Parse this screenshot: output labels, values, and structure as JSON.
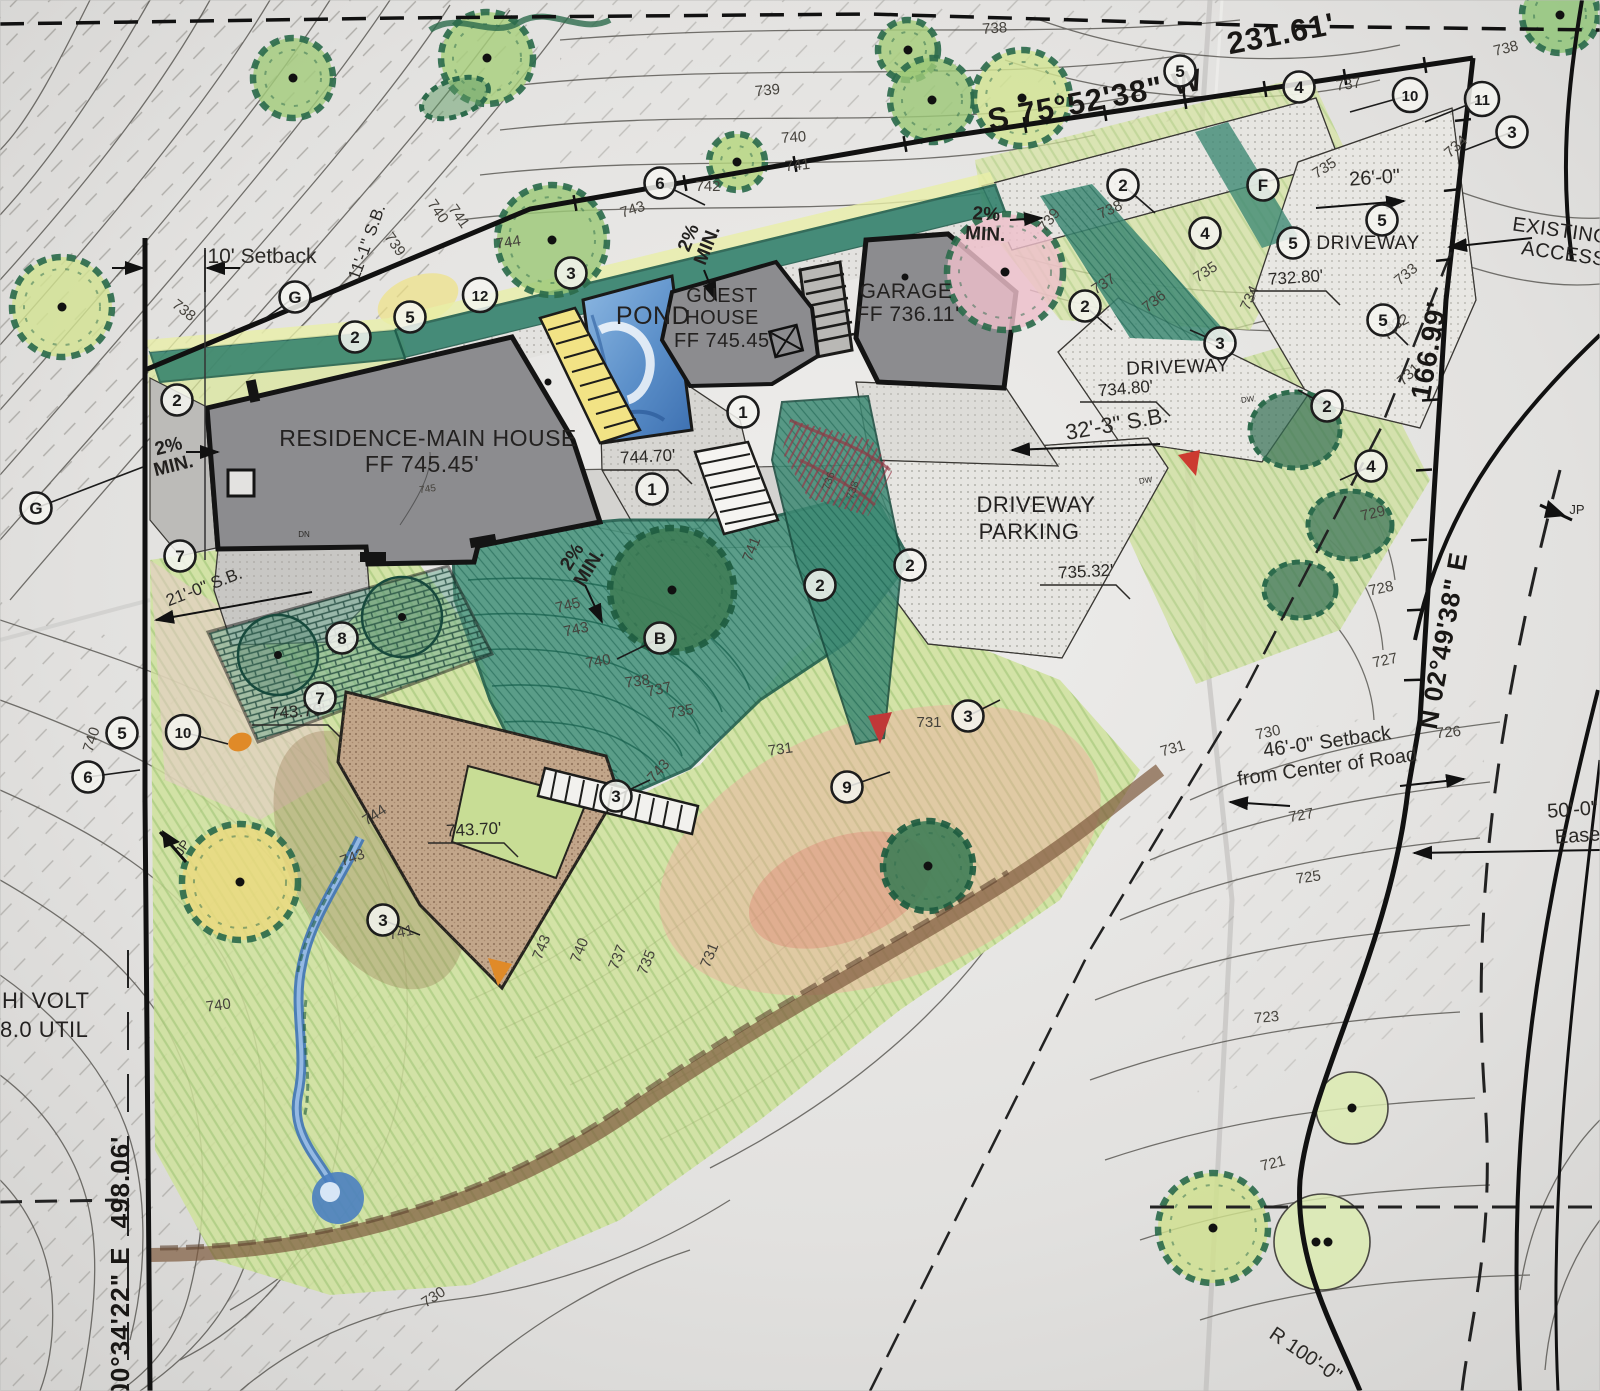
{
  "meta": {
    "description": "Hand-colored architectural site plan with residence, guest house, garage, pond and driveways over topographic contours"
  },
  "colors": {
    "paper": "#e3e2e0",
    "ink": "#2b2926",
    "building_gray": "#8c8c8f",
    "teal_planting": "#47937c",
    "lawn_green": "#cfe29b",
    "light_green": "#d6e4a0",
    "pink": "#eec0cb",
    "red_blush": "#f0a8a0",
    "pond_blue": "#5b8fc9",
    "patio_tan": "#c2a68a",
    "tree_yellow": "#ecd97e",
    "orange": "#e08a28"
  },
  "text_layers": {
    "bearings": [
      {
        "t": "231.61'",
        "x": 1283,
        "y": 44,
        "s": 31,
        "r": -11
      },
      {
        "t": "S 75°52'38\" W",
        "x": 1097,
        "y": 110,
        "s": 31,
        "r": -11
      },
      {
        "t": "166.99'",
        "x": 1438,
        "y": 352,
        "s": 28,
        "r": -80
      },
      {
        "t": "N 02°49'38\" E",
        "x": 1452,
        "y": 642,
        "s": 26,
        "r": -80
      },
      {
        "t": "498.06'",
        "x": 129,
        "y": 1182,
        "s": 26,
        "r": -90
      },
      {
        "t": "00°34'22\" E",
        "x": 129,
        "y": 1322,
        "s": 26,
        "r": -90
      }
    ],
    "buildings": [
      {
        "t": "RESIDENCE-MAIN HOUSE",
        "x": 428,
        "y": 446,
        "s": 23
      },
      {
        "t": "FF 745.45'",
        "x": 422,
        "y": 472,
        "s": 23
      },
      {
        "t": "GUEST",
        "x": 722,
        "y": 302,
        "s": 20
      },
      {
        "t": "HOUSE",
        "x": 722,
        "y": 324,
        "s": 20
      },
      {
        "t": "FF 745.45'",
        "x": 724,
        "y": 347,
        "s": 20
      },
      {
        "t": "GARAGE",
        "x": 906,
        "y": 298,
        "s": 21
      },
      {
        "t": "FF 736.11'",
        "x": 908,
        "y": 321,
        "s": 21
      }
    ],
    "site": [
      {
        "t": "POND",
        "x": 653,
        "y": 324,
        "s": 25
      },
      {
        "t": "DRIVEWAY",
        "x": 1368,
        "y": 249,
        "s": 19
      },
      {
        "t": "DRIVEWAY",
        "x": 1178,
        "y": 373,
        "s": 19,
        "r": -2
      },
      {
        "t": "DRIVEWAY",
        "x": 1036,
        "y": 512,
        "s": 22
      },
      {
        "t": "PARKING",
        "x": 1029,
        "y": 539,
        "s": 22
      },
      {
        "t": "EXISTING",
        "x": 1560,
        "y": 237,
        "s": 20,
        "r": 8
      },
      {
        "t": "ACCESS",
        "x": 1563,
        "y": 260,
        "s": 20,
        "r": 8
      },
      {
        "t": "HI VOLT",
        "x": 2,
        "y": 1008,
        "s": 22,
        "a": "start"
      },
      {
        "t": "8.0 UTIL",
        "x": 0,
        "y": 1037,
        "s": 22,
        "a": "start"
      }
    ],
    "dimensions": [
      {
        "t": "10' Setback",
        "x": 262,
        "y": 263,
        "s": 21
      },
      {
        "t": "11'-1\" S.B.",
        "x": 372,
        "y": 244,
        "s": 17,
        "r": -70
      },
      {
        "t": "26'-0\"",
        "x": 1375,
        "y": 184,
        "s": 20,
        "r": -4
      },
      {
        "t": "32'-3\" S.B.",
        "x": 1118,
        "y": 431,
        "s": 22,
        "r": -10
      },
      {
        "t": "21'-0\" S.B.",
        "x": 206,
        "y": 592,
        "s": 17,
        "r": -21
      },
      {
        "t": "46'-0\" Setback",
        "x": 1328,
        "y": 748,
        "s": 20,
        "r": -8
      },
      {
        "t": "from Center of Road",
        "x": 1328,
        "y": 773,
        "s": 20,
        "r": -8
      },
      {
        "t": "50'-0\"",
        "x": 1573,
        "y": 816,
        "s": 20,
        "r": -4
      },
      {
        "t": "Ease",
        "x": 1578,
        "y": 842,
        "s": 20,
        "r": -4
      },
      {
        "t": "R 100'-0\"",
        "x": 1302,
        "y": 1360,
        "s": 20,
        "r": 34
      }
    ],
    "spots": [
      {
        "t": "744.70'",
        "x": 648,
        "y": 462,
        "r": -3
      },
      {
        "t": "734.80'",
        "x": 1126,
        "y": 394,
        "r": -5
      },
      {
        "t": "732.80'",
        "x": 1296,
        "y": 283,
        "r": -4
      },
      {
        "t": "735.32'",
        "x": 1086,
        "y": 577,
        "r": -3
      },
      {
        "t": "743.70'",
        "x": 298,
        "y": 717,
        "r": -4
      },
      {
        "t": "743.70'",
        "x": 474,
        "y": 835,
        "r": -3
      }
    ],
    "slope_notes": [
      {
        "t": "2% MIN.",
        "x": 170,
        "y": 452,
        "r": -14
      },
      {
        "t": "2% MIN.",
        "x": 986,
        "y": 220,
        "r": 3
      },
      {
        "t": "2% MIN.",
        "x": 694,
        "y": 240,
        "r": -68
      },
      {
        "t": "2% MIN.",
        "x": 577,
        "y": 560,
        "r": -58
      }
    ],
    "contours": [
      {
        "t": "738",
        "x": 995,
        "y": 33,
        "r": -4
      },
      {
        "t": "739",
        "x": 768,
        "y": 95,
        "r": -6
      },
      {
        "t": "740",
        "x": 794,
        "y": 142,
        "r": -4
      },
      {
        "t": "741",
        "x": 798,
        "y": 170,
        "r": -6
      },
      {
        "t": "742",
        "x": 708,
        "y": 191,
        "r": 0
      },
      {
        "t": "743",
        "x": 634,
        "y": 214,
        "r": -18
      },
      {
        "t": "744",
        "x": 509,
        "y": 247,
        "r": -8
      },
      {
        "t": "738",
        "x": 181,
        "y": 314,
        "r": 38
      },
      {
        "t": "739",
        "x": 391,
        "y": 247,
        "r": 55
      },
      {
        "t": "740",
        "x": 434,
        "y": 214,
        "r": 55
      },
      {
        "t": "741",
        "x": 455,
        "y": 219,
        "r": 55
      },
      {
        "t": "738",
        "x": 1507,
        "y": 53,
        "r": -14
      },
      {
        "t": "737",
        "x": 1349,
        "y": 89,
        "r": -8
      },
      {
        "t": "735",
        "x": 1327,
        "y": 172,
        "r": -33
      },
      {
        "t": "734",
        "x": 1459,
        "y": 150,
        "r": -42
      },
      {
        "t": "733",
        "x": 1409,
        "y": 278,
        "r": -40
      },
      {
        "t": "732",
        "x": 1399,
        "y": 328,
        "r": -28
      },
      {
        "t": "739",
        "x": 1053,
        "y": 223,
        "r": -52
      },
      {
        "t": "738",
        "x": 1112,
        "y": 214,
        "r": -24
      },
      {
        "t": "737",
        "x": 1106,
        "y": 288,
        "r": -33
      },
      {
        "t": "736",
        "x": 1157,
        "y": 305,
        "r": -38
      },
      {
        "t": "735",
        "x": 1208,
        "y": 276,
        "r": -33
      },
      {
        "t": "734",
        "x": 1254,
        "y": 300,
        "r": -65
      },
      {
        "t": "732",
        "x": 1396,
        "y": 332,
        "r": -48
      },
      {
        "t": "731",
        "x": 1412,
        "y": 378,
        "r": -42
      },
      {
        "t": "729",
        "x": 1374,
        "y": 518,
        "r": -14
      },
      {
        "t": "728",
        "x": 1382,
        "y": 593,
        "r": -12
      },
      {
        "t": "727",
        "x": 1386,
        "y": 665,
        "r": -12
      },
      {
        "t": "726",
        "x": 1449,
        "y": 737,
        "r": -6
      },
      {
        "t": "730",
        "x": 1269,
        "y": 737,
        "r": -12
      },
      {
        "t": "731",
        "x": 1174,
        "y": 753,
        "r": -16
      },
      {
        "t": "727",
        "x": 1302,
        "y": 820,
        "r": -10
      },
      {
        "t": "725",
        "x": 1309,
        "y": 882,
        "r": -8
      },
      {
        "t": "723",
        "x": 1267,
        "y": 1022,
        "r": -5
      },
      {
        "t": "721",
        "x": 1274,
        "y": 1168,
        "r": -14
      },
      {
        "t": "745",
        "x": 569,
        "y": 610,
        "r": -14
      },
      {
        "t": "743",
        "x": 577,
        "y": 634,
        "r": -12
      },
      {
        "t": "740",
        "x": 599,
        "y": 666,
        "r": -10
      },
      {
        "t": "738",
        "x": 638,
        "y": 686,
        "r": -8
      },
      {
        "t": "737",
        "x": 660,
        "y": 694,
        "r": -12
      },
      {
        "t": "735",
        "x": 682,
        "y": 716,
        "r": -10
      },
      {
        "t": "731",
        "x": 781,
        "y": 754,
        "r": -8
      },
      {
        "t": "731",
        "x": 929,
        "y": 727,
        "r": 0
      },
      {
        "t": "741",
        "x": 756,
        "y": 551,
        "r": -68
      },
      {
        "t": "744",
        "x": 377,
        "y": 819,
        "r": -33
      },
      {
        "t": "743",
        "x": 354,
        "y": 862,
        "r": -20
      },
      {
        "t": "741",
        "x": 402,
        "y": 937,
        "r": -12
      },
      {
        "t": "743",
        "x": 662,
        "y": 774,
        "r": -48
      },
      {
        "t": "743",
        "x": 546,
        "y": 949,
        "r": -68
      },
      {
        "t": "740",
        "x": 584,
        "y": 952,
        "r": -68
      },
      {
        "t": "737",
        "x": 622,
        "y": 959,
        "r": -68
      },
      {
        "t": "735",
        "x": 651,
        "y": 964,
        "r": -68
      },
      {
        "t": "731",
        "x": 714,
        "y": 957,
        "r": -68
      },
      {
        "t": "740",
        "x": 219,
        "y": 1010,
        "r": -8
      },
      {
        "t": "740",
        "x": 96,
        "y": 741,
        "r": -72
      },
      {
        "t": "730",
        "x": 436,
        "y": 1301,
        "r": -33
      },
      {
        "t": "745",
        "x": 428,
        "y": 492,
        "r": -8,
        "s": 10
      },
      {
        "t": "736",
        "x": 832,
        "y": 482,
        "r": -72,
        "s": 11,
        "c": "#703040"
      },
      {
        "t": "738",
        "x": 856,
        "y": 491,
        "r": -72,
        "s": 11,
        "c": "#703040"
      }
    ],
    "misc": [
      {
        "t": "JP",
        "x": 1577,
        "y": 514,
        "s": 13
      },
      {
        "t": "JP",
        "x": 186,
        "y": 850,
        "s": 13,
        "r": -55
      },
      {
        "t": "DW",
        "x": 1146,
        "y": 483,
        "s": 8,
        "r": -8
      },
      {
        "t": "DW",
        "x": 1248,
        "y": 402,
        "s": 8,
        "r": -8
      },
      {
        "t": "DN",
        "x": 304,
        "y": 537,
        "s": 8
      }
    ]
  },
  "keynotes": [
    {
      "n": "G",
      "x": 295,
      "y": 297,
      "lx": 263,
      "ly": 320
    },
    {
      "n": "G",
      "x": 36,
      "y": 508,
      "lx": 143,
      "ly": 467
    },
    {
      "n": "B",
      "x": 660,
      "y": 638,
      "lx": 617,
      "ly": 659
    },
    {
      "n": "F",
      "x": 1263,
      "y": 185
    },
    {
      "n": "1",
      "x": 652,
      "y": 489
    },
    {
      "n": "1",
      "x": 743,
      "y": 412
    },
    {
      "n": "2",
      "x": 355,
      "y": 337
    },
    {
      "n": "2",
      "x": 177,
      "y": 400
    },
    {
      "n": "2",
      "x": 1123,
      "y": 185,
      "lx": 1155,
      "ly": 213
    },
    {
      "n": "2",
      "x": 1085,
      "y": 306,
      "lx": 1112,
      "ly": 330
    },
    {
      "n": "2",
      "x": 820,
      "y": 585
    },
    {
      "n": "2",
      "x": 910,
      "y": 565
    },
    {
      "n": "2",
      "x": 1327,
      "y": 406,
      "lx": 1298,
      "ly": 390
    },
    {
      "n": "3",
      "x": 571,
      "y": 273
    },
    {
      "n": "3",
      "x": 1512,
      "y": 132,
      "lx": 1465,
      "ly": 150
    },
    {
      "n": "3",
      "x": 1220,
      "y": 343,
      "lx": 1190,
      "ly": 330
    },
    {
      "n": "3",
      "x": 968,
      "y": 716,
      "lx": 1000,
      "ly": 700
    },
    {
      "n": "3",
      "x": 616,
      "y": 796,
      "lx": 650,
      "ly": 780
    },
    {
      "n": "3",
      "x": 383,
      "y": 920,
      "lx": 420,
      "ly": 935
    },
    {
      "n": "4",
      "x": 1299,
      "y": 87
    },
    {
      "n": "4",
      "x": 1205,
      "y": 233
    },
    {
      "n": "4",
      "x": 1371,
      "y": 466,
      "lx": 1340,
      "ly": 480
    },
    {
      "n": "5",
      "x": 410,
      "y": 317
    },
    {
      "n": "5",
      "x": 1180,
      "y": 71
    },
    {
      "n": "5",
      "x": 1382,
      "y": 220
    },
    {
      "n": "5",
      "x": 1293,
      "y": 243
    },
    {
      "n": "5",
      "x": 1383,
      "y": 320,
      "lx": 1408,
      "ly": 345
    },
    {
      "n": "5",
      "x": 122,
      "y": 733
    },
    {
      "n": "6",
      "x": 660,
      "y": 183,
      "lx": 705,
      "ly": 205
    },
    {
      "n": "6",
      "x": 88,
      "y": 777,
      "lx": 140,
      "ly": 770
    },
    {
      "n": "7",
      "x": 180,
      "y": 556
    },
    {
      "n": "7",
      "x": 320,
      "y": 698
    },
    {
      "n": "8",
      "x": 342,
      "y": 638
    },
    {
      "n": "9",
      "x": 847,
      "y": 787,
      "lx": 890,
      "ly": 772
    },
    {
      "n": "10",
      "x": 183,
      "y": 732,
      "lx": 228,
      "ly": 744
    },
    {
      "n": "10",
      "x": 1410,
      "y": 95,
      "lx": 1350,
      "ly": 112
    },
    {
      "n": "11",
      "x": 1482,
      "y": 99,
      "lx": 1425,
      "ly": 122
    },
    {
      "n": "12",
      "x": 480,
      "y": 295
    }
  ]
}
